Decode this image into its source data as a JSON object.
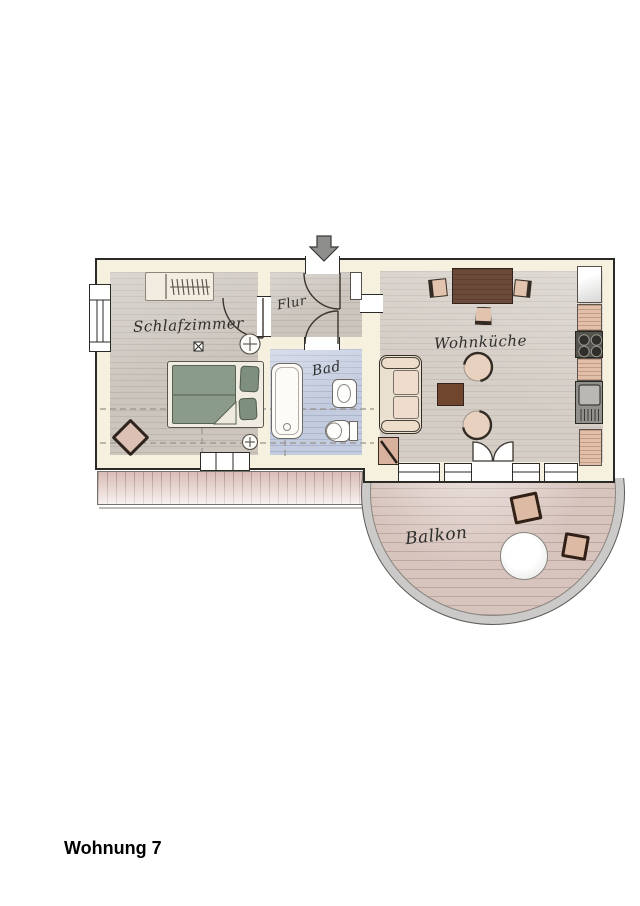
{
  "page": {
    "title": "Wohnung 7"
  },
  "plan": {
    "entrance_arrow": "down",
    "rooms": [
      {
        "id": "schlafzimmer",
        "label": "Schlafzimmer"
      },
      {
        "id": "flur",
        "label": "Flur"
      },
      {
        "id": "bad",
        "label": "Bad"
      },
      {
        "id": "wohnkueche",
        "label": "Wohnküche"
      },
      {
        "id": "balkon",
        "label": "Balkon"
      }
    ],
    "furniture": {
      "schlafzimmer": [
        "wardrobe",
        "double-bed",
        "corner-chair",
        "ceiling-lamp",
        "wall-lamps",
        "window"
      ],
      "bad": [
        "bathtub",
        "washbasin",
        "toilet"
      ],
      "wohnkueche": [
        "dining-table",
        "three-chairs",
        "sofa",
        "two-armchairs",
        "side-table",
        "corner-shelf",
        "fridge",
        "counter",
        "stove",
        "sink",
        "balcony-double-door"
      ],
      "balkon": [
        "round-table",
        "two-chairs"
      ],
      "outside": [
        "terrace-deck"
      ]
    },
    "colors": {
      "wall_fill": "#f6f1de",
      "wall_outline": "#2a2a26",
      "wood_floor": "#ccc5be",
      "bath_floor": "#c3cbde",
      "terrace_planks": "#e4cdc7",
      "balcony_floor": "#d7c4bd",
      "bed_textile": "#8a9a8b",
      "furniture_wood": "#6b4a39",
      "cushion": "#e2c3ae",
      "fixture_white": "#fdfdfb",
      "arrow_gray": "#8e8e8c"
    }
  }
}
